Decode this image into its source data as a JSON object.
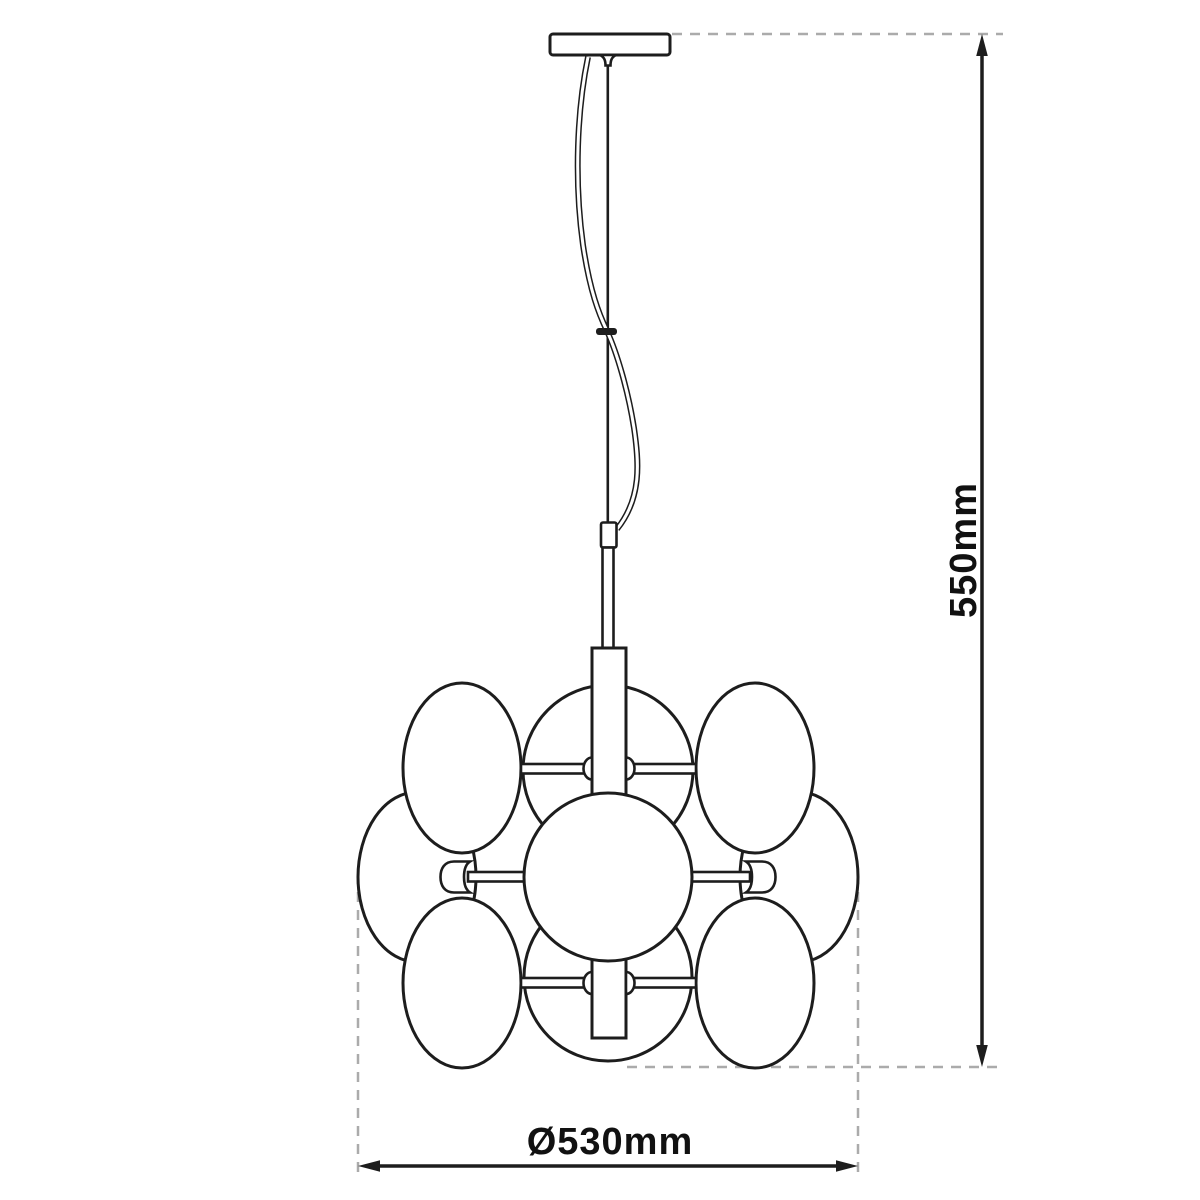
{
  "diagram": {
    "type": "pendant-lamp-dimension-drawing",
    "dimensions": {
      "height": {
        "label": "550mm"
      },
      "diameter": {
        "label": "Ø530mm"
      }
    },
    "colors": {
      "line": "#1d1d1d",
      "guide": "#ababab",
      "text": "#111111",
      "background": "#ffffff"
    }
  }
}
